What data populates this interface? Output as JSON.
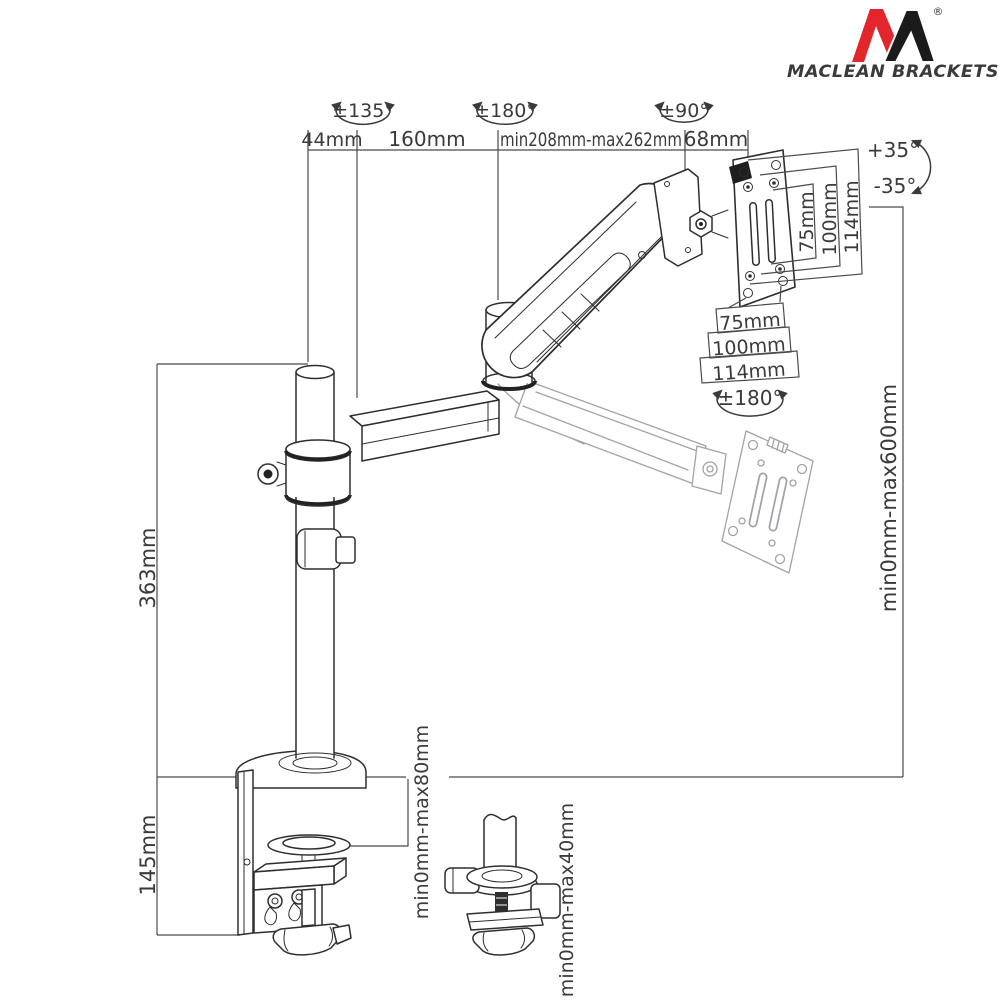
{
  "colors": {
    "brand_red": "#e2262b",
    "ink": "#2e2e2e"
  },
  "brand": {
    "name": "MACLEAN BRACKETS",
    "registered": "®"
  },
  "labels": {
    "top_44": "44mm",
    "top_160": "160mm",
    "top_208_262": "min208mm-max262mm",
    "top_68": "68mm",
    "rot_135": "±135°",
    "rot_180_top": "±180°",
    "rot_90": "±90°",
    "rot_180_vesa": "±180°",
    "tilt_up": "+35°",
    "tilt_down": "-35°",
    "vesa_v_75": "75mm",
    "vesa_v_100": "100mm",
    "vesa_v_114": "114mm",
    "vesa_h_75": "75mm",
    "vesa_h_100": "100mm",
    "vesa_h_114": "114mm",
    "height_range": "min0mm-max600mm",
    "pole_height": "363mm",
    "clamp_height": "145mm",
    "desk_thickness": "min0mm-max80mm",
    "grommet_thickness": "min0mm-max40mm"
  }
}
